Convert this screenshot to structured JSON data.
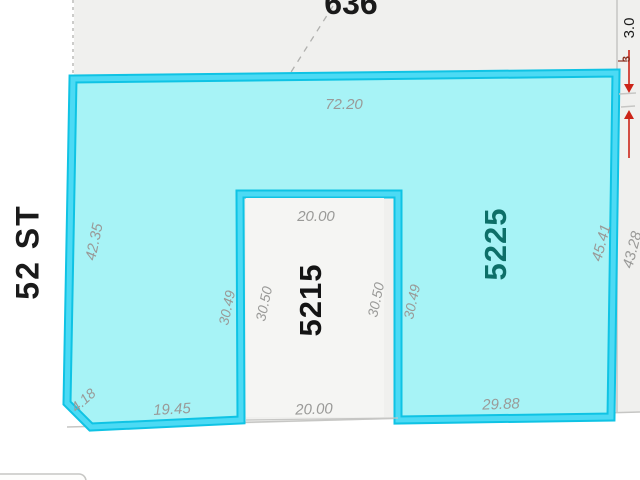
{
  "map": {
    "street_label": "52 ST",
    "block_number": "636",
    "parcels": {
      "highlighted": {
        "id": "5225",
        "selected": true
      },
      "inner": {
        "id": "5215",
        "selected": false
      }
    },
    "dimensions": {
      "top_edge": "72.20",
      "left_edge": "42.35",
      "bevel_edge": "4.18",
      "bottom_left_edge": "19.45",
      "inner_top": "20.00",
      "inner_bottom": "20.00",
      "inner_left_outside": "30.49",
      "inner_left_inside": "30.50",
      "inner_right_inside": "30.50",
      "inner_right_outside": "30.49",
      "bottom_right_edge": "29.88",
      "right_edge_inside": "45.41",
      "right_edge_outside": "43.28",
      "gap_callout": "3.0",
      "gap_callout_small": "3"
    },
    "colors": {
      "parcel_fill": "#a7f3f6",
      "parcel_border_dark": "#0fc3e4",
      "parcel_border_bright": "#4cdaf4",
      "inner_lot_fill": "#f5f5f3",
      "block_fill": "#f0f0ee",
      "lot_line": "#c6c6c4",
      "dashed_line": "#b0b0ae",
      "dim_text": "#9a9a98",
      "parcel_id_main": "#0d6f68",
      "parcel_id_inner": "#141414",
      "street_text": "#1a1a1a",
      "arrow_red": "#cc2418",
      "gap_small_red": "#8a2f1f"
    }
  }
}
